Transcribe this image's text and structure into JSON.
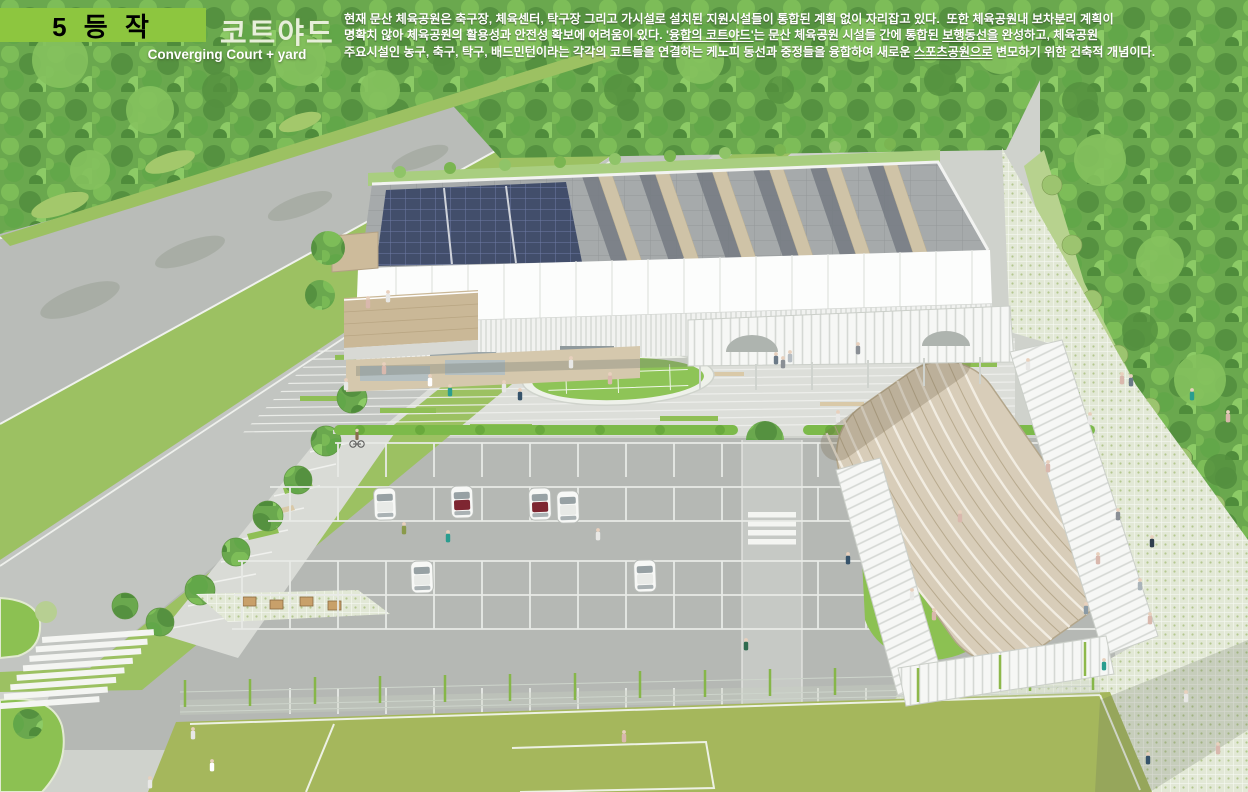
{
  "header": {
    "award_badge": "5 등 작",
    "title_ko": "코트야드",
    "subtitle_en": "Converging Court + yard",
    "description_lines": [
      {
        "parts": [
          {
            "text": "현재 문산 체육공원은 축구장, 체육센터, 탁구장 그리고 가시설로 설치된 지원시설들이 통합된 계획 없이 자리잡고 있다.  또한 체육공원내 보차분리 계획이",
            "underline": false
          }
        ]
      },
      {
        "parts": [
          {
            "text": "명확치 않아 체육공원의 활용성과 안전성 확보에 어려움이 있다. ",
            "underline": false
          },
          {
            "text": "'융합의 코트야드'",
            "underline": true
          },
          {
            "text": "는 문산 체육공원 시설들 간에 통합된 ",
            "underline": false
          },
          {
            "text": "보행동선을",
            "underline": true
          },
          {
            "text": " 완성하고, 체육공원",
            "underline": false
          }
        ]
      },
      {
        "parts": [
          {
            "text": "주요시설인 농구, 축구, 탁구, 배드민턴이라는 각각의 코트들을 연결하는 케노피 동선과 중정들을 융합하여 새로운 ",
            "underline": false
          },
          {
            "text": "스포츠공원으로",
            "underline": true
          },
          {
            "text": " 변모하기 위한 건축적 개념이다.",
            "underline": false
          }
        ]
      }
    ]
  },
  "colors": {
    "banner": "#8dc63f",
    "banner_text": "#000000",
    "title_text": "#e7efda",
    "body_text": "#ffffff",
    "forest": "#6aa84e",
    "grass": "#9cc162",
    "field": "#a5b75c",
    "road": "#b9bcb8",
    "plaza": "#dcded9",
    "parking": "#b5b8b4",
    "solar_panel": "#424e6b",
    "roof_gray": "#a6aaab",
    "wood_beige": "#cdbb9b",
    "vault_beige": "#d8cdb9",
    "hedge": "#7cba4a",
    "fence_post": "#86b649",
    "lawn_oval": "#8ec457",
    "car_accent_maroon": "#7e2631"
  }
}
